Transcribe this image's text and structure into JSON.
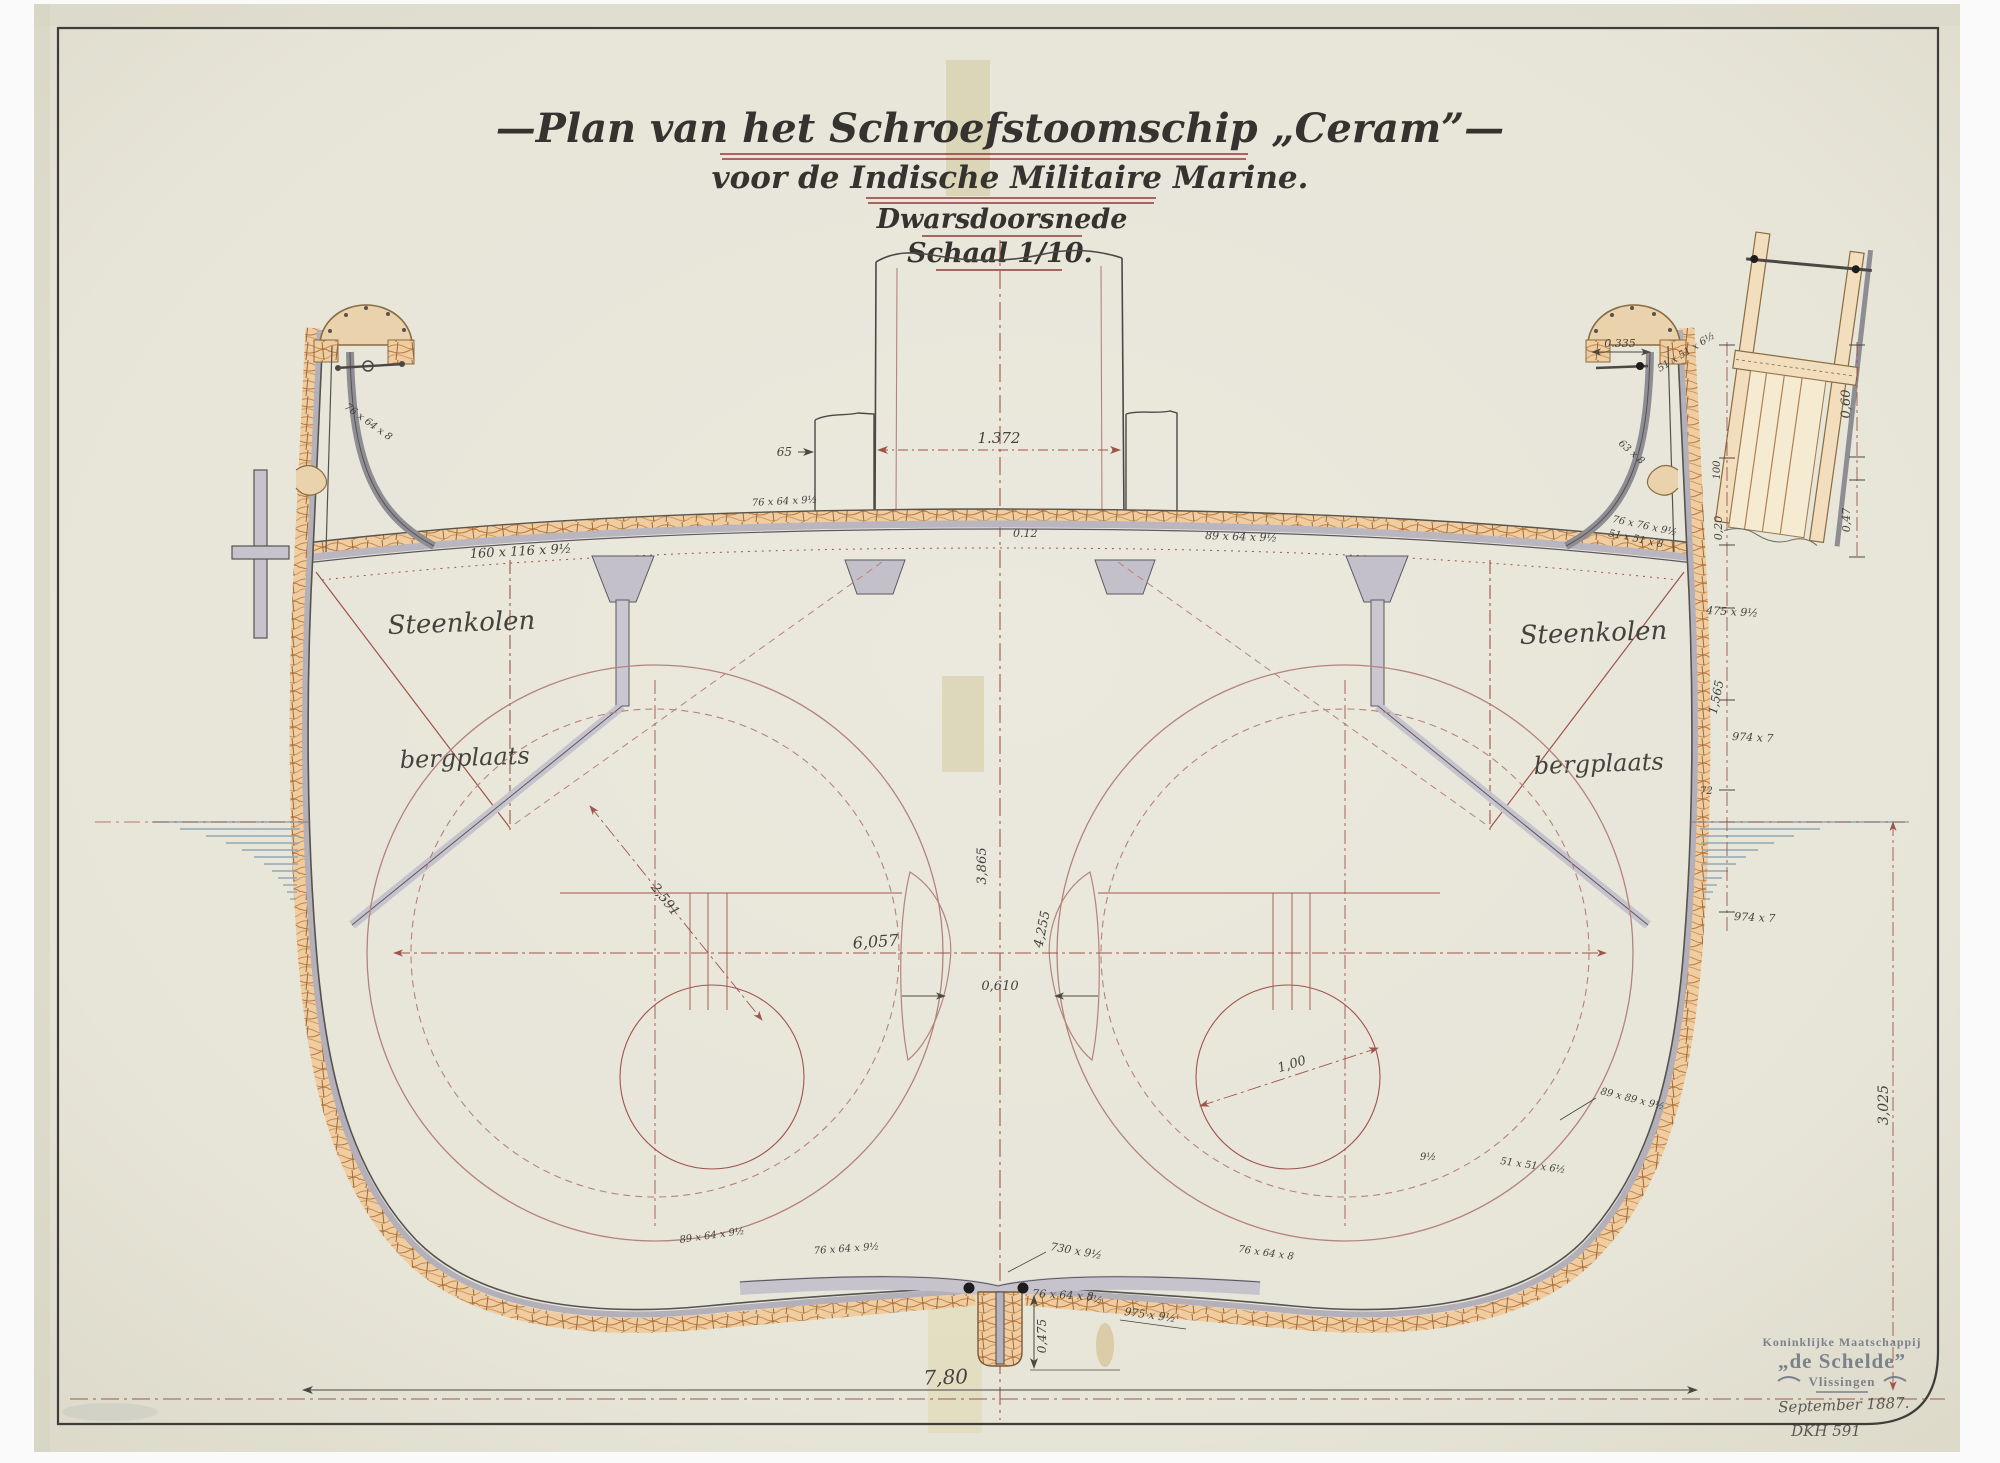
{
  "title": {
    "line1": "—Plan van het Schroefstoomschip „Ceram”—",
    "line2": "voor de Indische Militaire Marine.",
    "line3": "Dwarsdoorsnede",
    "line4": "Schaal 1/10."
  },
  "compartments": {
    "left_upper": "Steenkolen",
    "left_lower": "bergplaats",
    "right_upper": "Steenkolen",
    "right_lower": "bergplaats"
  },
  "dimensions": {
    "funnel_width": "1.372",
    "funnel_side": "65",
    "deck_center": "0.12",
    "centerline_height": "3,865",
    "hold_depth": "4,255",
    "boiler_room_width": "6,057",
    "boiler_gap": "0,610",
    "boiler_diameter": "2,591",
    "furnace_diameter": "1,00",
    "beam_overall": "7,80",
    "keel_depth": "0,475",
    "bulwark_opening": "0.335",
    "chain_bulwark": "0,60",
    "chain_rail": "100",
    "chain_sheer": "0,47",
    "chain_deck_edge": "0,20",
    "chain_strake": "1,565",
    "chain_side": "3,025",
    "waterline_mark": "72"
  },
  "specs": {
    "deck_beam_left": "160 x 116 x 9½",
    "deck_beam_right": "89 x 64 x 9½",
    "deck_angle_left": "76 x 64 x 9½",
    "bulwark_angle_left": "76 x 64 x 8",
    "bulwark_angle_right": "51 x 51 x 6½",
    "rail_plate_right": "63 x 8",
    "gunwale_angle_right": "76 x 76 x 9½",
    "gunwale_bar_right": "51 x 51 x 8",
    "sheer_plate": "475 x 9½",
    "side_plate_upper": "974 x 7",
    "side_plate_lower": "974 x 7",
    "bilge_angle_a": "89 x 89 x 9½",
    "bilge_angle_b": "51 x 51 x 6½",
    "bilge_thickness": "9½",
    "bottom_plate_right": "975 x 9½",
    "keel_plate": "730 x 9½",
    "keel_angle": "76 x 64 x 8",
    "keel_rabbet": "7½",
    "bottom_left_a": "89 x 64 x 9½",
    "bottom_left_b": "76 x 64 x 9½",
    "bottom_right_a": "76 x 64 x 8"
  },
  "stamp": {
    "line1": "Koninklijke Maatschappij",
    "line2": "„de Schelde”",
    "line3": "Vlissingen",
    "date": "September 1887.",
    "pencil": "DKH 591"
  }
}
